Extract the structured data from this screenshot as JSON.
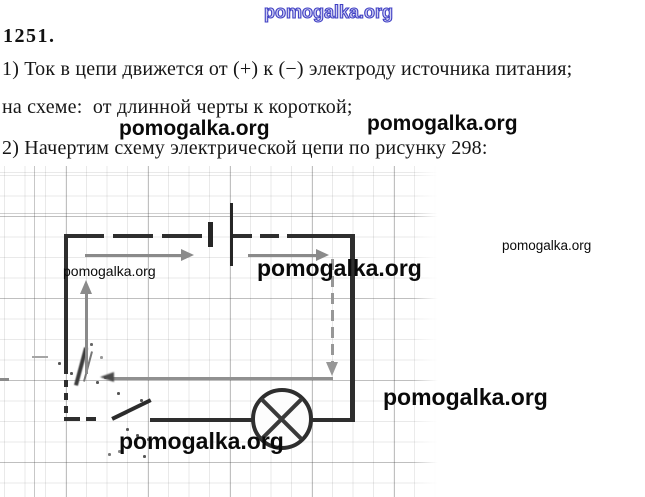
{
  "watermark": {
    "text": "pomogalka.org",
    "color": "#0a0a0a",
    "blue_outline_color": "#4040c4"
  },
  "header": {
    "problem_number": "1251."
  },
  "solution": {
    "line1": "1) Ток в цепи движется от (+) к (−) электроду источника питания;",
    "line2": "на схеме:  от длинной черты к короткой;",
    "line3": "2) Начертим схему электрической цепи по рисунку 298:"
  },
  "diagram": {
    "type": "electric-circuit-schematic",
    "background": "graph-paper",
    "components": [
      "battery",
      "open-switch-key",
      "lamp"
    ],
    "current_direction": "clockwise",
    "colors": {
      "wire": "#2e2e2e",
      "arrow": "#8a8a8a",
      "grid_light": "#e9e9e9",
      "grid_dark": "#bdbdbd"
    }
  }
}
